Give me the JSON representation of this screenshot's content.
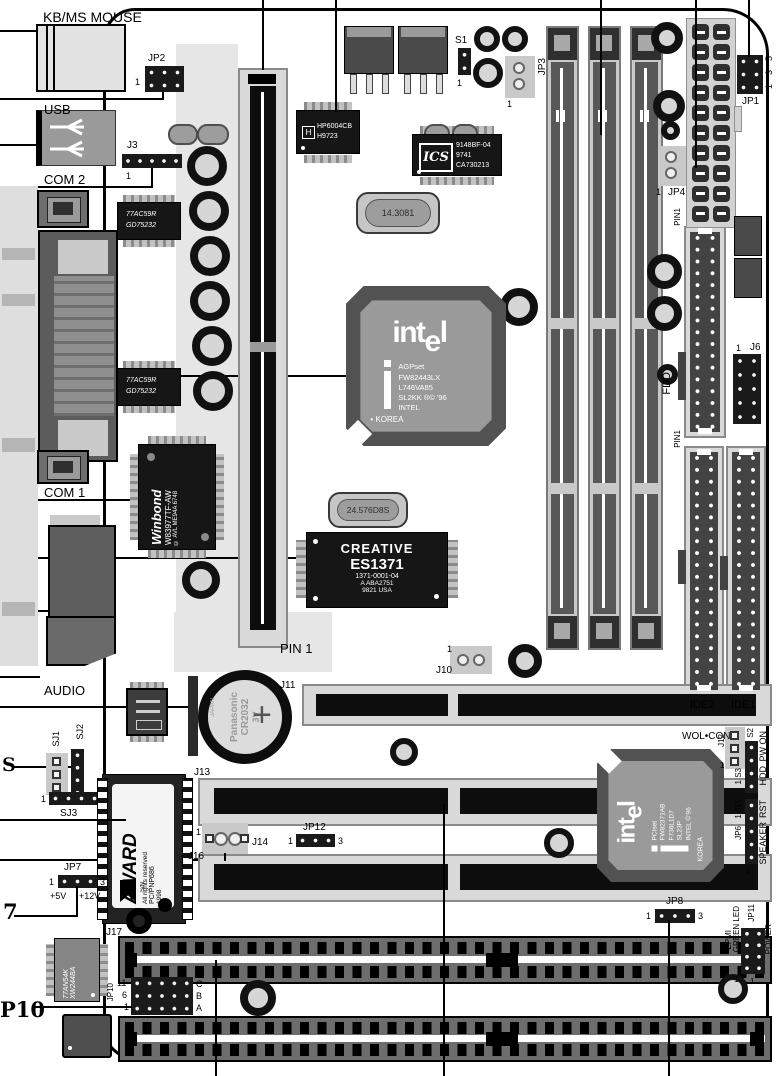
{
  "meta": {
    "type": "motherboard-layout-diagram"
  },
  "labels": {
    "kb_ms": "KB/MS MOUSE",
    "usb": "USB",
    "com2": "COM 2",
    "com1": "COM 1",
    "audio": "AUDIO",
    "jp2": "JP2",
    "j3": "J3",
    "s1": "S1",
    "jp3": "JP3",
    "jp1": "JP1",
    "jp4": "JP4",
    "pin1": "PIN1",
    "pin_1": "PIN 1",
    "fdd": "FDD",
    "j6": "J6",
    "ide2": "IDE2",
    "ide1": "IDE1",
    "j10": "J10",
    "j11": "J11",
    "j13": "J13",
    "j14": "J14",
    "jp12": "JP12",
    "j16": "J16",
    "j17": "J17",
    "jp7": "JP7",
    "jp8": "JP8",
    "jp10": "JP10",
    "jp11": "JP11",
    "sj1": "SJ1",
    "sj2": "SJ2",
    "sj3": "SJ3",
    "wol_con": "WOL•CON",
    "j12": "J12",
    "s2": "S2",
    "s3": "1 S3",
    "j15": "1 J15",
    "jp6": "JP6",
    "pw_on": "PW ON",
    "hdd": "HDD",
    "rst": "RST",
    "speaker": "SPEAKER",
    "epmi": "EPMI",
    "green_led": "GREEN LED",
    "power": "POWER",
    "plus5v": "+5V",
    "plus12v": "+12V",
    "callout_s": "S",
    "callout_7": "7",
    "callout_p10": "P10",
    "pin_c": "C",
    "pin_b": "B",
    "pin_a": "A",
    "pin_11": "11",
    "pin_6": "6",
    "one": "1",
    "three": "3",
    "five": "5"
  },
  "chips": {
    "regulator": {
      "logo": "H",
      "l1": "HP6004CB",
      "l2": "H9723"
    },
    "clock_gen": {
      "logo": "ICS",
      "l1": "9148BF-04",
      "l2": "9741",
      "l3": "CA730213"
    },
    "xtal_main": "14.3081",
    "xtal_audio": "24.576D8S",
    "northbridge": {
      "logo_a": "int",
      "logo_b": "e",
      "logo_c": "l",
      "l1": "AGPset",
      "l2": "FW82443LX",
      "l3": "L746VA85",
      "l4": "SL2KK ®© '96",
      "l5": "INTEL",
      "l6": "• KOREA"
    },
    "southbridge": {
      "logo_a": "int",
      "logo_b": "e",
      "logo_c": "l",
      "l1": "PCIset",
      "l2": "FW82371AB",
      "l3": "F736L1D7",
      "l4": "SL23P",
      "l5": "INTEL ©'96",
      "l6": "KOREA"
    },
    "super_io": {
      "logo": "Winbond",
      "l1": "W83977TF-AW",
      "l2": "© AVL ME94A 6748"
    },
    "audio_codec": {
      "l1": "CREATIVE",
      "l2": "ES1371",
      "l3": "1371-0001-04",
      "l4": "A ABA2751",
      "l5": "9821  USA"
    },
    "bios": {
      "logo": "AWARD",
      "l1": "All rights reserved",
      "l2": "PC/PNP686",
      "l3": "1998",
      "l4": "S/N"
    },
    "com_driver": {
      "l1": "77AC59R",
      "l2": "GD75232"
    },
    "logic_ic": {
      "l1": "77AN54K",
      "l2": "XW244BA"
    },
    "battery": {
      "l1": "Panasonic",
      "l2": "CR2032",
      "l3": "3V",
      "l4": "JAPAN"
    }
  },
  "colors": {
    "line": "#000000",
    "chip_dark": "#161616",
    "silk": "#c9c9c9",
    "board": "#ffffff"
  }
}
